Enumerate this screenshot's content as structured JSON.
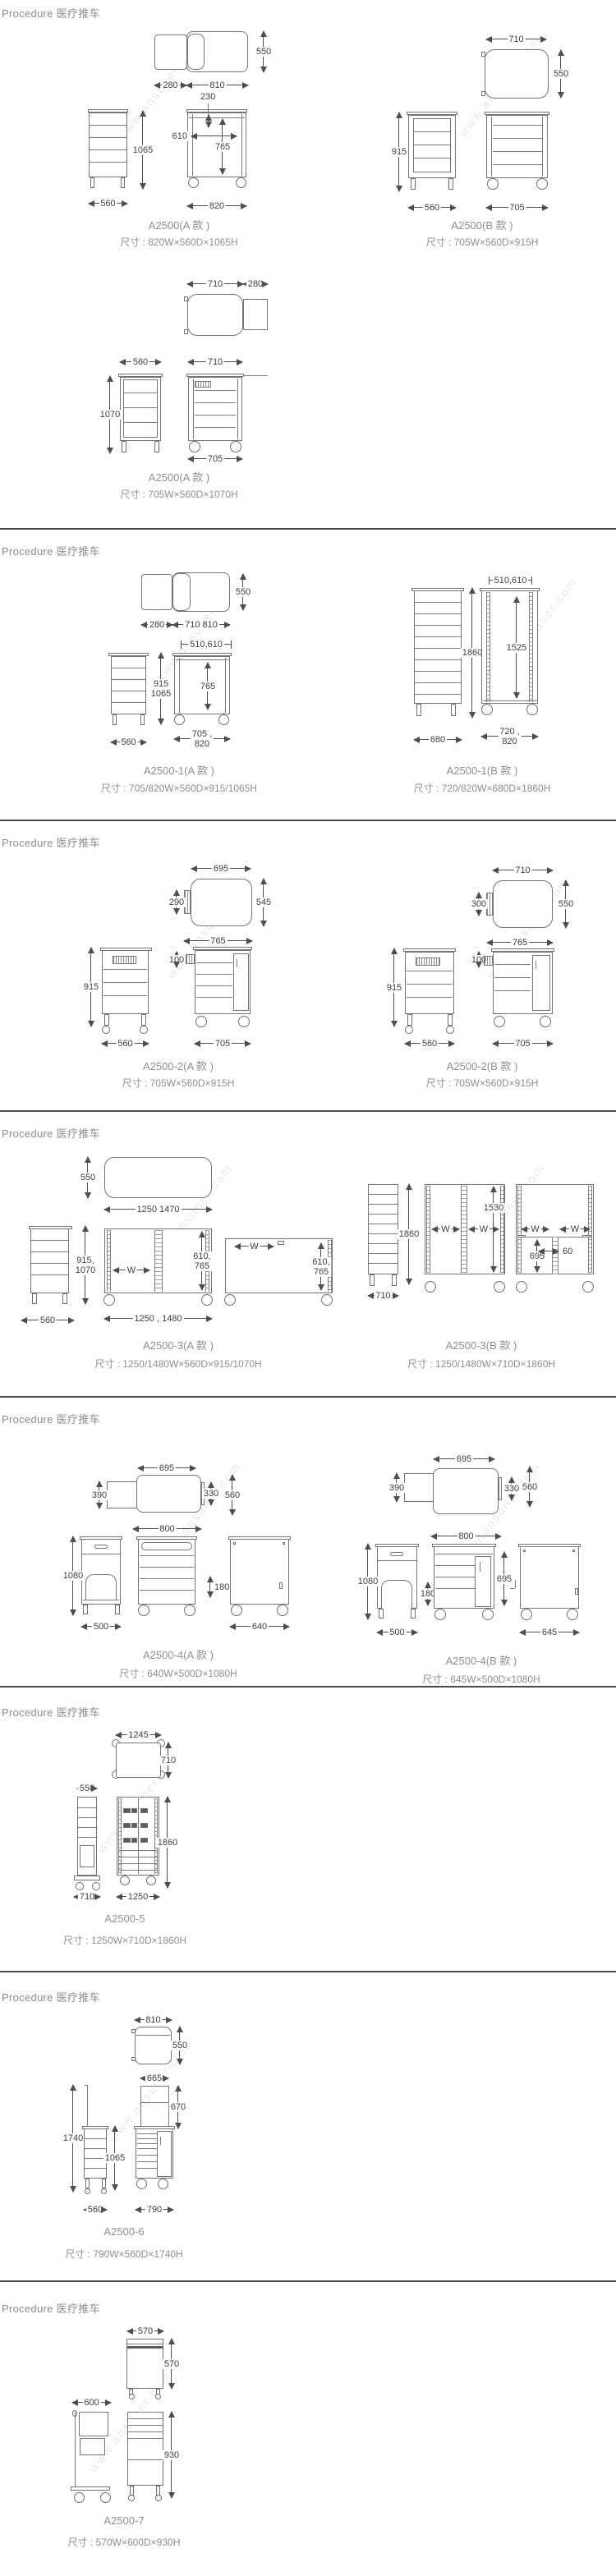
{
  "watermark": "www.ansuner.com",
  "sections": [
    {
      "title": "Procedure 医疗推车",
      "groups": [
        {
          "model": "A2500(A 款 )",
          "size": "尺寸 : 820W×560D×1065H",
          "dims": [
            "550",
            "280",
            "810",
            "230",
            "610",
            "765",
            "1065",
            "560",
            "820"
          ]
        },
        {
          "model": "A2500(B 款 )",
          "size": "尺寸 : 705W×560D×915H",
          "dims": [
            "710",
            "550",
            "915",
            "560",
            "705"
          ]
        },
        {
          "model": "A2500(A 款 )",
          "size": "尺寸 : 705W×560D×1070H",
          "dims": [
            "710",
            "280",
            "560",
            "710",
            "1070",
            "705"
          ]
        }
      ]
    },
    {
      "title": "Procedure 医疗推车",
      "groups": [
        {
          "model": "A2500-1(A 款 )",
          "size": "尺寸 : 705/820W×560D×915/1065H",
          "dims": [
            "550",
            "280",
            "710 810",
            "510,610",
            "915\n1065",
            "765",
            "560",
            "705 ,\n820"
          ]
        },
        {
          "model": "A2500-1(B 款 )",
          "size": "尺寸 : 720/820W×680D×1860H",
          "dims": [
            "510,610",
            "1860",
            "1525",
            "680",
            "720 ,\n820"
          ]
        }
      ]
    },
    {
      "title": "Procedure 医疗推车",
      "groups": [
        {
          "model": "A2500-2(A 款 )",
          "size": "尺寸 : 705W×560D×915H",
          "dims": [
            "695",
            "290",
            "545",
            "765",
            "100",
            "915",
            "560",
            "705"
          ]
        },
        {
          "model": "A2500-2(B 款 )",
          "size": "尺寸 : 705W×560D×915H",
          "dims": [
            "710",
            "300",
            "550",
            "765",
            "100",
            "915",
            "560",
            "705"
          ]
        }
      ]
    },
    {
      "title": "Procedure 医疗推车",
      "groups": [
        {
          "model": "A2500-3(A 款 )",
          "size": "尺寸 : 1250/1480W×560D×915/1070H",
          "dims": [
            "550",
            "1250 1470",
            "915,\n1070",
            "560",
            "W",
            "610,\n765",
            "1250 , 1480",
            "W",
            "610,\n765"
          ]
        },
        {
          "model": "A2500-3(B 款 )",
          "size": "尺寸 : 1250/1480W×710D×1860H",
          "dims": [
            "1860",
            "710",
            "1530",
            "W",
            "W",
            "W",
            "W",
            "695",
            "60"
          ]
        }
      ]
    },
    {
      "title": "Procedure 医疗推车",
      "groups": [
        {
          "model": "A2500-4(A 款 )",
          "size": "尺寸 : 640W×500D×1080H",
          "dims": [
            "695",
            "390",
            "330",
            "560",
            "800",
            "1080",
            "500",
            "180",
            "640"
          ]
        },
        {
          "model": "A2500-4(B 款 )",
          "size": "尺寸 : 645W×500D×1080H",
          "dims": [
            "695",
            "390",
            "330",
            "560",
            "800",
            "1080",
            "180",
            "500",
            "695",
            "645"
          ]
        }
      ]
    },
    {
      "title": "Procedure 医疗推车",
      "groups": [
        {
          "model": "A2500-5",
          "size": "尺寸 : 1250W×710D×1860H",
          "dims": [
            "1245",
            "710",
            "550",
            "710",
            "1860",
            "1250"
          ]
        }
      ]
    },
    {
      "title": "Procedure 医疗推车",
      "groups": [
        {
          "model": "A2500-6",
          "size": "尺寸 : 790W×560D×1740H",
          "dims": [
            "810",
            "550",
            "665",
            "670",
            "1740",
            "1065",
            "560",
            "790"
          ]
        }
      ]
    },
    {
      "title": "Procedure 医疗推车",
      "groups": [
        {
          "model": "A2500-7",
          "size": "尺寸 : 570W×600D×930H",
          "dims": [
            "570",
            "570",
            "600",
            "930"
          ]
        }
      ]
    }
  ]
}
